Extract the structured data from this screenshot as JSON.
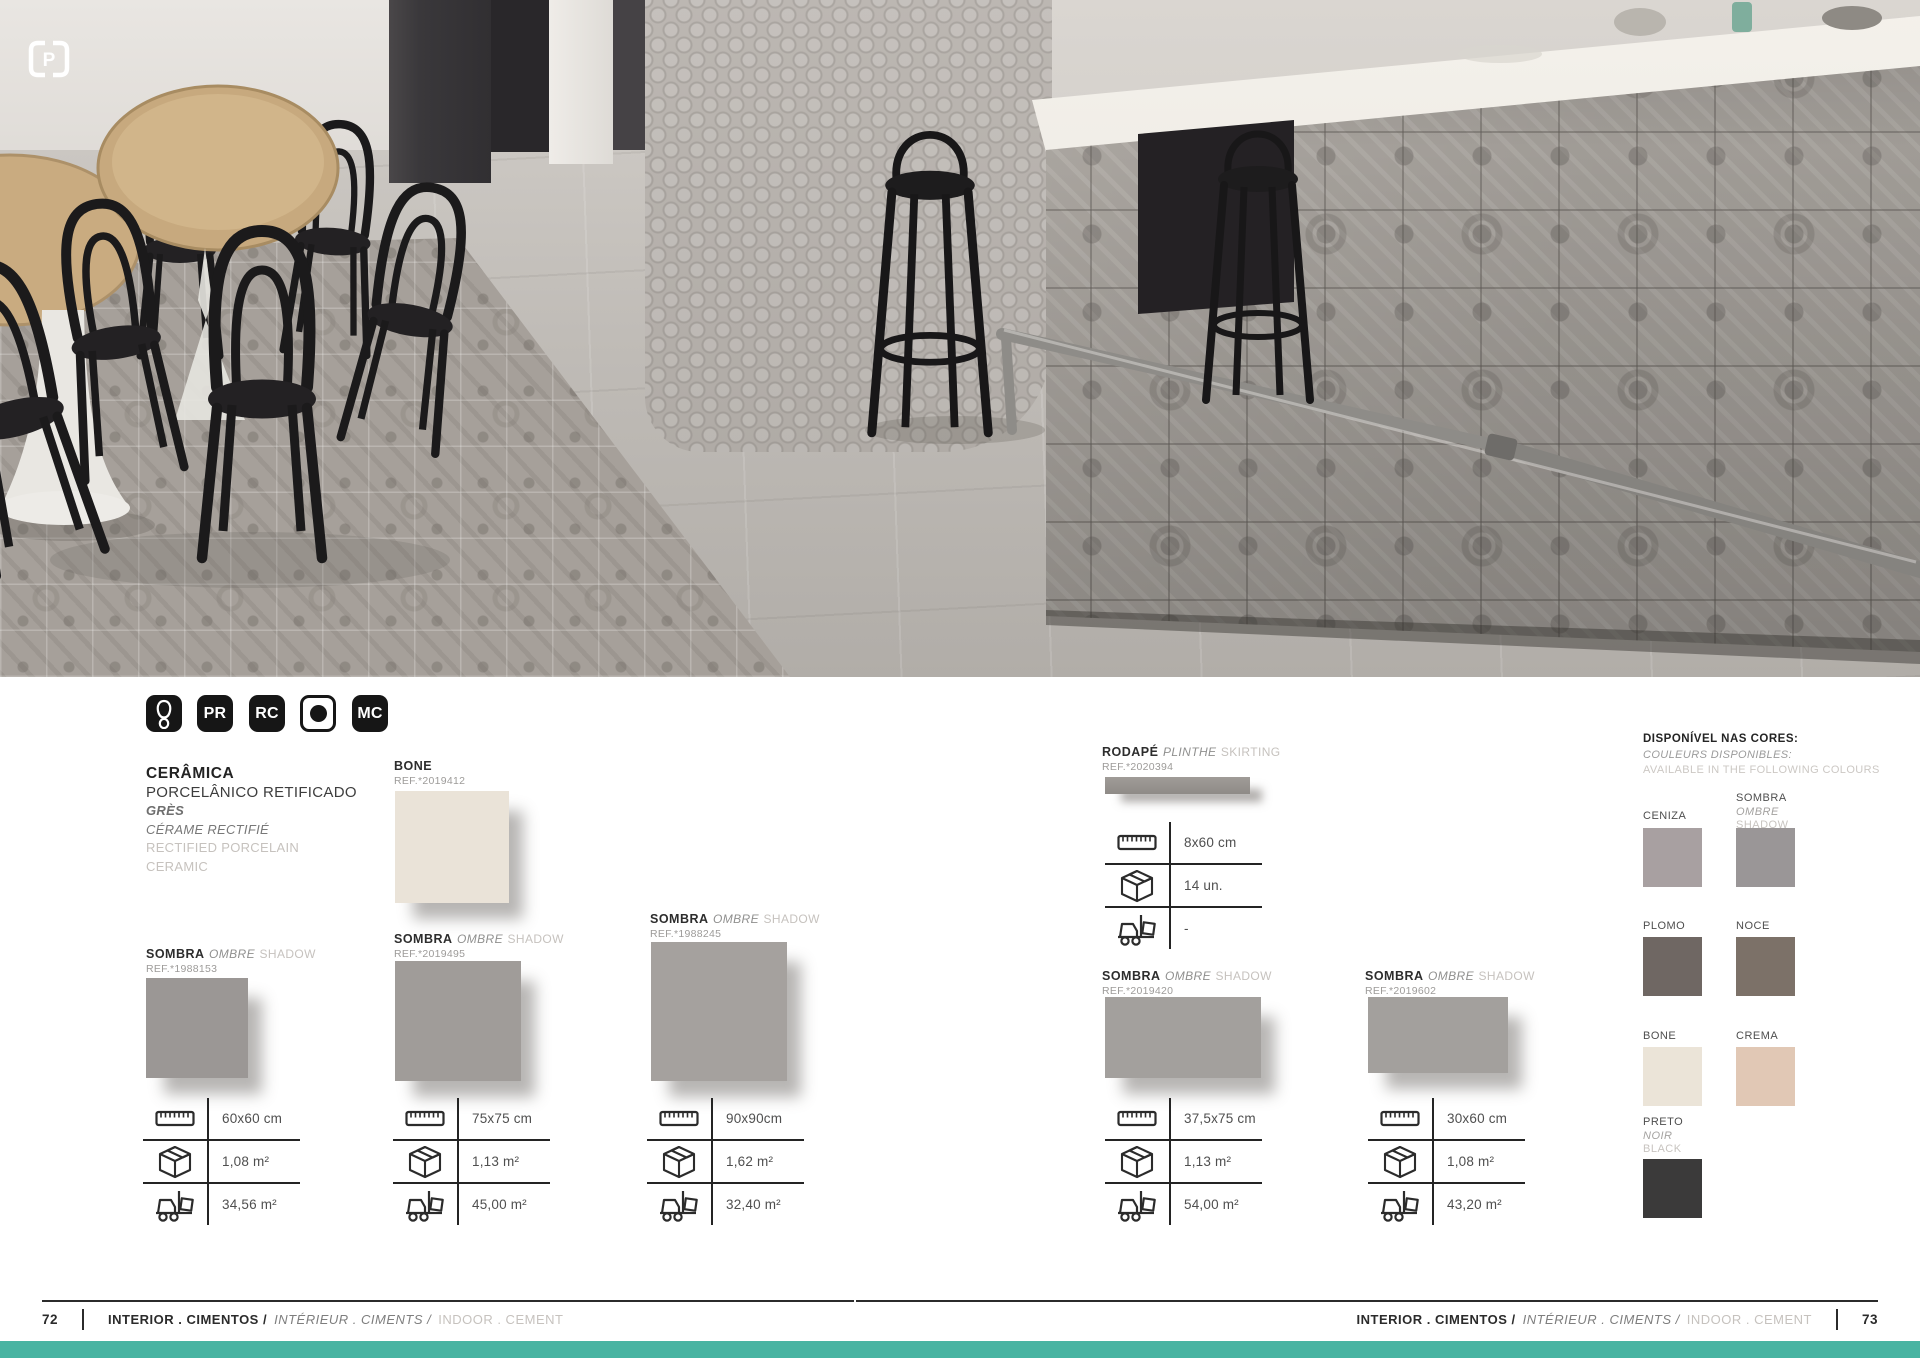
{
  "page": {
    "left_number": "72",
    "right_number": "73",
    "footer": {
      "pt": "INTERIOR . CIMENTOS /",
      "fr": "INTÉRIEUR . CIMENTS /",
      "en": "INDOOR . CEMENT"
    },
    "teal_bar_color": "#48b4a2"
  },
  "brand": {
    "logo_letter": "P"
  },
  "badges": {
    "items": [
      {
        "label": "",
        "icon": "footprint-icon",
        "style": "dark"
      },
      {
        "label": "PR",
        "style": "dark"
      },
      {
        "label": "RC",
        "style": "dark"
      },
      {
        "label": "",
        "icon": "dot-icon",
        "style": "light"
      },
      {
        "label": "MC",
        "style": "dark"
      }
    ]
  },
  "intro": {
    "title": "CERÂMICA",
    "subtitle": "PORCELÂNICO RETIFICADO",
    "fr1": "GRÈS",
    "fr2": "CÉRAME RECTIFIÉ",
    "en1": "RECTIFIED PORCELAIN",
    "en2": "CERAMIC"
  },
  "products": [
    {
      "name": "SOMBRA",
      "name_fr": "OMBRE",
      "name_en": "SHADOW",
      "ref": "REF.*1988153",
      "swatch": "#9b9795",
      "size": "60x60 cm",
      "box": "1,08 m²",
      "pallet": "34,56 m²"
    },
    {
      "name": "BONE",
      "name_fr": "",
      "name_en": "",
      "ref": "REF.*2019412",
      "swatch": "#eae3d8"
    },
    {
      "name": "SOMBRA",
      "name_fr": "OMBRE",
      "name_en": "SHADOW",
      "ref": "REF.*2019495",
      "swatch": "#a09c99",
      "size": "75x75 cm",
      "box": "1,13 m²",
      "pallet": "45,00 m²"
    },
    {
      "name": "SOMBRA",
      "name_fr": "OMBRE",
      "name_en": "SHADOW",
      "ref": "REF.*1988245",
      "swatch": "#a5a19e",
      "size": "90x90cm",
      "box": "1,62 m²",
      "pallet": "32,40 m²"
    },
    {
      "name": "RODAPÉ",
      "name_fr": "PLINTHE",
      "name_en": "SKIRTING",
      "ref": "REF.*2020394",
      "swatch": "#98948f",
      "size": "8x60 cm",
      "box": "14 un.",
      "pallet": "-"
    },
    {
      "name": "SOMBRA",
      "name_fr": "OMBRE",
      "name_en": "SHADOW",
      "ref": "REF.*2019420",
      "swatch": "#a3a09d",
      "size": "37,5x75 cm",
      "box": "1,13 m²",
      "pallet": "54,00 m²"
    },
    {
      "name": "SOMBRA",
      "name_fr": "OMBRE",
      "name_en": "SHADOW",
      "ref": "REF.*2019602",
      "swatch": "#a3a09d",
      "size": "30x60 cm",
      "box": "1,08 m²",
      "pallet": "43,20 m²"
    }
  ],
  "colors_panel": {
    "title": "DISPONÍVEL NAS CORES:",
    "subtitle_fr": "COULEURS DISPONIBLES:",
    "subtitle_en": "AVAILABLE IN THE FOLLOWING COLOURS",
    "swatches": [
      {
        "name": "CENIZA",
        "fr": "",
        "en": "",
        "hex": "#a8a0a1"
      },
      {
        "name": "SOMBRA",
        "fr": "OMBRE",
        "en": "SHADOW",
        "hex": "#9a9697"
      },
      {
        "name": "PLOMO",
        "fr": "",
        "en": "",
        "hex": "#6f6763"
      },
      {
        "name": "NOCE",
        "fr": "",
        "en": "",
        "hex": "#7c7168"
      },
      {
        "name": "BONE",
        "fr": "",
        "en": "",
        "hex": "#ebe4d8"
      },
      {
        "name": "CREMA",
        "fr": "",
        "en": "",
        "hex": "#e1c8b5"
      },
      {
        "name": "PRETO",
        "fr": "NOIR",
        "en": "BLACK",
        "hex": "#3b3a3a"
      }
    ]
  }
}
